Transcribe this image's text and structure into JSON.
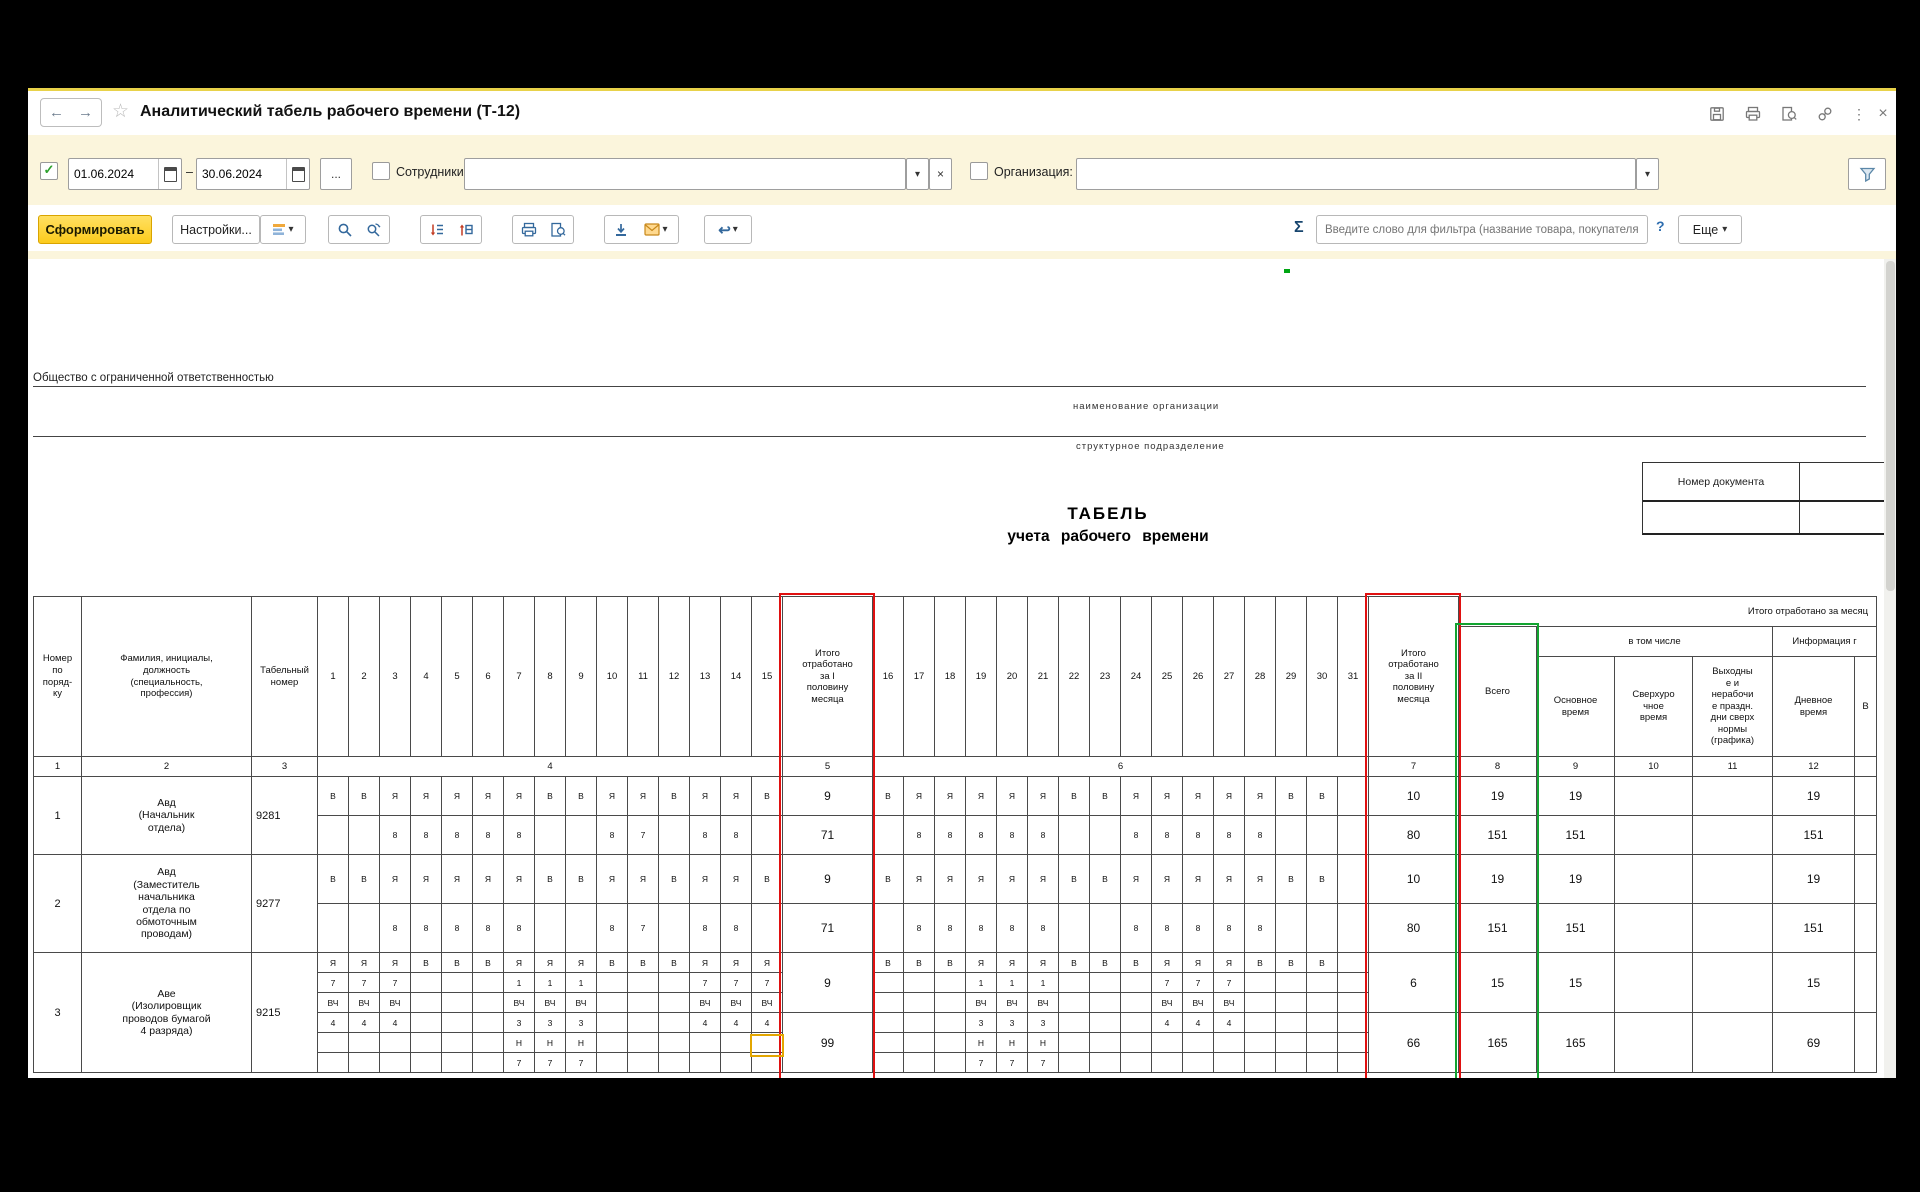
{
  "titlebar": {
    "title": "Аналитический табель рабочего времени (Т-12)",
    "back_glyph": "←",
    "forward_glyph": "→",
    "star_glyph": "☆",
    "kebab_glyph": "⋮",
    "close_glyph": "×",
    "icons": [
      "save-icon",
      "print-icon",
      "preview-icon",
      "link-icon",
      "kebab-icon",
      "close-icon"
    ]
  },
  "filterbar": {
    "period_checked": "✓",
    "date_from": "01.06.2024",
    "date_to": "30.06.2024",
    "dash": "–",
    "dots_label": "...",
    "employees_label": "Сотрудники:",
    "employees_value": "",
    "organization_label": "Организация:",
    "organization_value": "",
    "dropdown_glyph": "▾",
    "clear_glyph": "×"
  },
  "toolbar": {
    "generate": "Сформировать",
    "settings": "Настройки...",
    "sigma": "Σ",
    "search_placeholder": "Введите слово для фильтра (название товара, покупателя и пр.)",
    "help": "?",
    "more": "Еще",
    "undo_glyph": "↩",
    "dropdown_glyph": "▾"
  },
  "colors": {
    "accent_red": "#e01010",
    "accent_green": "#12a430",
    "selection_yellow": "#e3a600",
    "panel_yellow": "#fbf5dc",
    "button_yellow": "#fccb1c"
  },
  "sheet": {
    "org_line": "Общество с ограниченной ответственностью",
    "org_caption": "наименование организации",
    "division_caption": "структурное подразделение",
    "doc_number_label": "Номер документа",
    "doc_date_label": "Дата\nсоставл",
    "doc_number_value": "",
    "doc_date_value": "24.03.2",
    "title1": "ТАБЕЛЬ",
    "title2": "учета рабочего времени",
    "banner": "Итого отработано за месяц",
    "including": "в том числе",
    "info_group": "Информация г",
    "headers": {
      "num": "Номер\nпо\nпоряд-\nку",
      "name": "Фамилия, инициалы,\nдолжность\n(специальность,\nпрофессия)",
      "tab": "Табельный\nномер",
      "total1": "Итого\nотработано\nза I\nполовину\nмесяца",
      "total2": "Итого\nотработано\nза II\nполовину\nмесяца",
      "vsego": "Всего",
      "osn": "Основное\nвремя",
      "sverh": "Сверхуро\nчное\nвремя",
      "vyh": "Выходны\nе и\nнерабочи\nе праздн.\nдни сверх\nнормы\n(графика)",
      "dnev": "Дневное\nвремя",
      "extra": "В"
    },
    "days1": [
      "1",
      "2",
      "3",
      "4",
      "5",
      "6",
      "7",
      "8",
      "9",
      "10",
      "11",
      "12",
      "13",
      "14",
      "15"
    ],
    "days2": [
      "16",
      "17",
      "18",
      "19",
      "20",
      "21",
      "22",
      "23",
      "24",
      "25",
      "26",
      "27",
      "28",
      "29",
      "30",
      "31"
    ],
    "col_numbers": [
      "1",
      "2",
      "3",
      "4",
      "5",
      "6",
      "7",
      "8",
      "9",
      "10",
      "11",
      "12"
    ],
    "rows": [
      {
        "num": "1",
        "name": "Авд\n(Начальник\nотдела)",
        "tab": "9281",
        "line_h": 39,
        "lines": [
          {
            "d1": [
              "В",
              "В",
              "Я",
              "Я",
              "Я",
              "Я",
              "Я",
              "В",
              "В",
              "Я",
              "Я",
              "В",
              "Я",
              "Я",
              "В"
            ],
            "d2": [
              "В",
              "Я",
              "Я",
              "Я",
              "Я",
              "Я",
              "В",
              "В",
              "Я",
              "Я",
              "Я",
              "Я",
              "Я",
              "В",
              "В",
              ""
            ]
          },
          {
            "d1": [
              "",
              "",
              "8",
              "8",
              "8",
              "8",
              "8",
              "",
              "",
              "8",
              "7",
              "",
              "8",
              "8",
              ""
            ],
            "d2": [
              "",
              "8",
              "8",
              "8",
              "8",
              "8",
              "",
              "",
              "8",
              "8",
              "8",
              "8",
              "8",
              "",
              "",
              ""
            ]
          }
        ],
        "totals": [
          {
            "at": 0,
            "span": 1,
            "t1": "9",
            "t2": "10",
            "vsego": "19",
            "osn": "19",
            "sverh": "",
            "vyh": "",
            "dnev": "19",
            "extra": ""
          },
          {
            "at": 1,
            "span": 1,
            "t1": "71",
            "t2": "80",
            "vsego": "151",
            "osn": "151",
            "sverh": "",
            "vyh": "",
            "dnev": "151",
            "extra": ""
          }
        ]
      },
      {
        "num": "2",
        "name": "Авд\n(Заместитель\nначальника\nотдела по\nобмоточным\nпроводам)",
        "tab": "9277",
        "line_h": 49,
        "lines": [
          {
            "d1": [
              "В",
              "В",
              "Я",
              "Я",
              "Я",
              "Я",
              "Я",
              "В",
              "В",
              "Я",
              "Я",
              "В",
              "Я",
              "Я",
              "В"
            ],
            "d2": [
              "В",
              "Я",
              "Я",
              "Я",
              "Я",
              "Я",
              "В",
              "В",
              "Я",
              "Я",
              "Я",
              "Я",
              "Я",
              "В",
              "В",
              ""
            ]
          },
          {
            "d1": [
              "",
              "",
              "8",
              "8",
              "8",
              "8",
              "8",
              "",
              "",
              "8",
              "7",
              "",
              "8",
              "8",
              ""
            ],
            "d2": [
              "",
              "8",
              "8",
              "8",
              "8",
              "8",
              "",
              "",
              "8",
              "8",
              "8",
              "8",
              "8",
              "",
              "",
              ""
            ]
          }
        ],
        "totals": [
          {
            "at": 0,
            "span": 1,
            "t1": "9",
            "t2": "10",
            "vsego": "19",
            "osn": "19",
            "sverh": "",
            "vyh": "",
            "dnev": "19",
            "extra": ""
          },
          {
            "at": 1,
            "span": 1,
            "t1": "71",
            "t2": "80",
            "vsego": "151",
            "osn": "151",
            "sverh": "",
            "vyh": "",
            "dnev": "151",
            "extra": ""
          }
        ]
      },
      {
        "num": "3",
        "name": "Аве\n(Изолировщик\nпроводов бумагой\n4 разряда)",
        "tab": "9215",
        "line_h": 20,
        "lines": [
          {
            "d1": [
              "Я",
              "Я",
              "Я",
              "В",
              "В",
              "В",
              "Я",
              "Я",
              "Я",
              "В",
              "В",
              "В",
              "Я",
              "Я",
              "Я"
            ],
            "d2": [
              "В",
              "В",
              "В",
              "Я",
              "Я",
              "Я",
              "В",
              "В",
              "В",
              "Я",
              "Я",
              "Я",
              "В",
              "В",
              "В",
              ""
            ]
          },
          {
            "d1": [
              "7",
              "7",
              "7",
              "",
              "",
              "",
              "1",
              "1",
              "1",
              "",
              "",
              "",
              "7",
              "7",
              "7"
            ],
            "d2": [
              "",
              "",
              "",
              "1",
              "1",
              "1",
              "",
              "",
              "",
              "7",
              "7",
              "7",
              "",
              "",
              "",
              ""
            ]
          },
          {
            "d1": [
              "ВЧ",
              "ВЧ",
              "ВЧ",
              "",
              "",
              "",
              "ВЧ",
              "ВЧ",
              "ВЧ",
              "",
              "",
              "",
              "ВЧ",
              "ВЧ",
              "ВЧ"
            ],
            "d2": [
              "",
              "",
              "",
              "ВЧ",
              "ВЧ",
              "ВЧ",
              "",
              "",
              "",
              "ВЧ",
              "ВЧ",
              "ВЧ",
              "",
              "",
              "",
              ""
            ]
          },
          {
            "d1": [
              "4",
              "4",
              "4",
              "",
              "",
              "",
              "3",
              "3",
              "3",
              "",
              "",
              "",
              "4",
              "4",
              "4"
            ],
            "d2": [
              "",
              "",
              "",
              "3",
              "3",
              "3",
              "",
              "",
              "",
              "4",
              "4",
              "4",
              "",
              "",
              "",
              ""
            ]
          },
          {
            "d1": [
              "",
              "",
              "",
              "",
              "",
              "",
              "Н",
              "Н",
              "Н",
              "",
              "",
              "",
              "",
              "",
              ""
            ],
            "d2": [
              "",
              "",
              "",
              "Н",
              "Н",
              "Н",
              "",
              "",
              "",
              "",
              "",
              "",
              "",
              "",
              "",
              ""
            ]
          },
          {
            "d1": [
              "",
              "",
              "",
              "",
              "",
              "",
              "7",
              "7",
              "7",
              "",
              "",
              "",
              "",
              "",
              ""
            ],
            "d2": [
              "",
              "",
              "",
              "7",
              "7",
              "7",
              "",
              "",
              "",
              "",
              "",
              "",
              "",
              "",
              "",
              ""
            ]
          }
        ],
        "totals": [
          {
            "at": 0,
            "span": 3,
            "t1": "9",
            "t2": "6",
            "vsego": "15",
            "osn": "15",
            "sverh": "",
            "vyh": "",
            "dnev": "15",
            "extra": ""
          },
          {
            "at": 3,
            "span": 3,
            "t1": "99",
            "t2": "66",
            "vsego": "165",
            "osn": "165",
            "sverh": "",
            "vyh": "",
            "dnev": "69",
            "extra": ""
          }
        ]
      }
    ]
  }
}
